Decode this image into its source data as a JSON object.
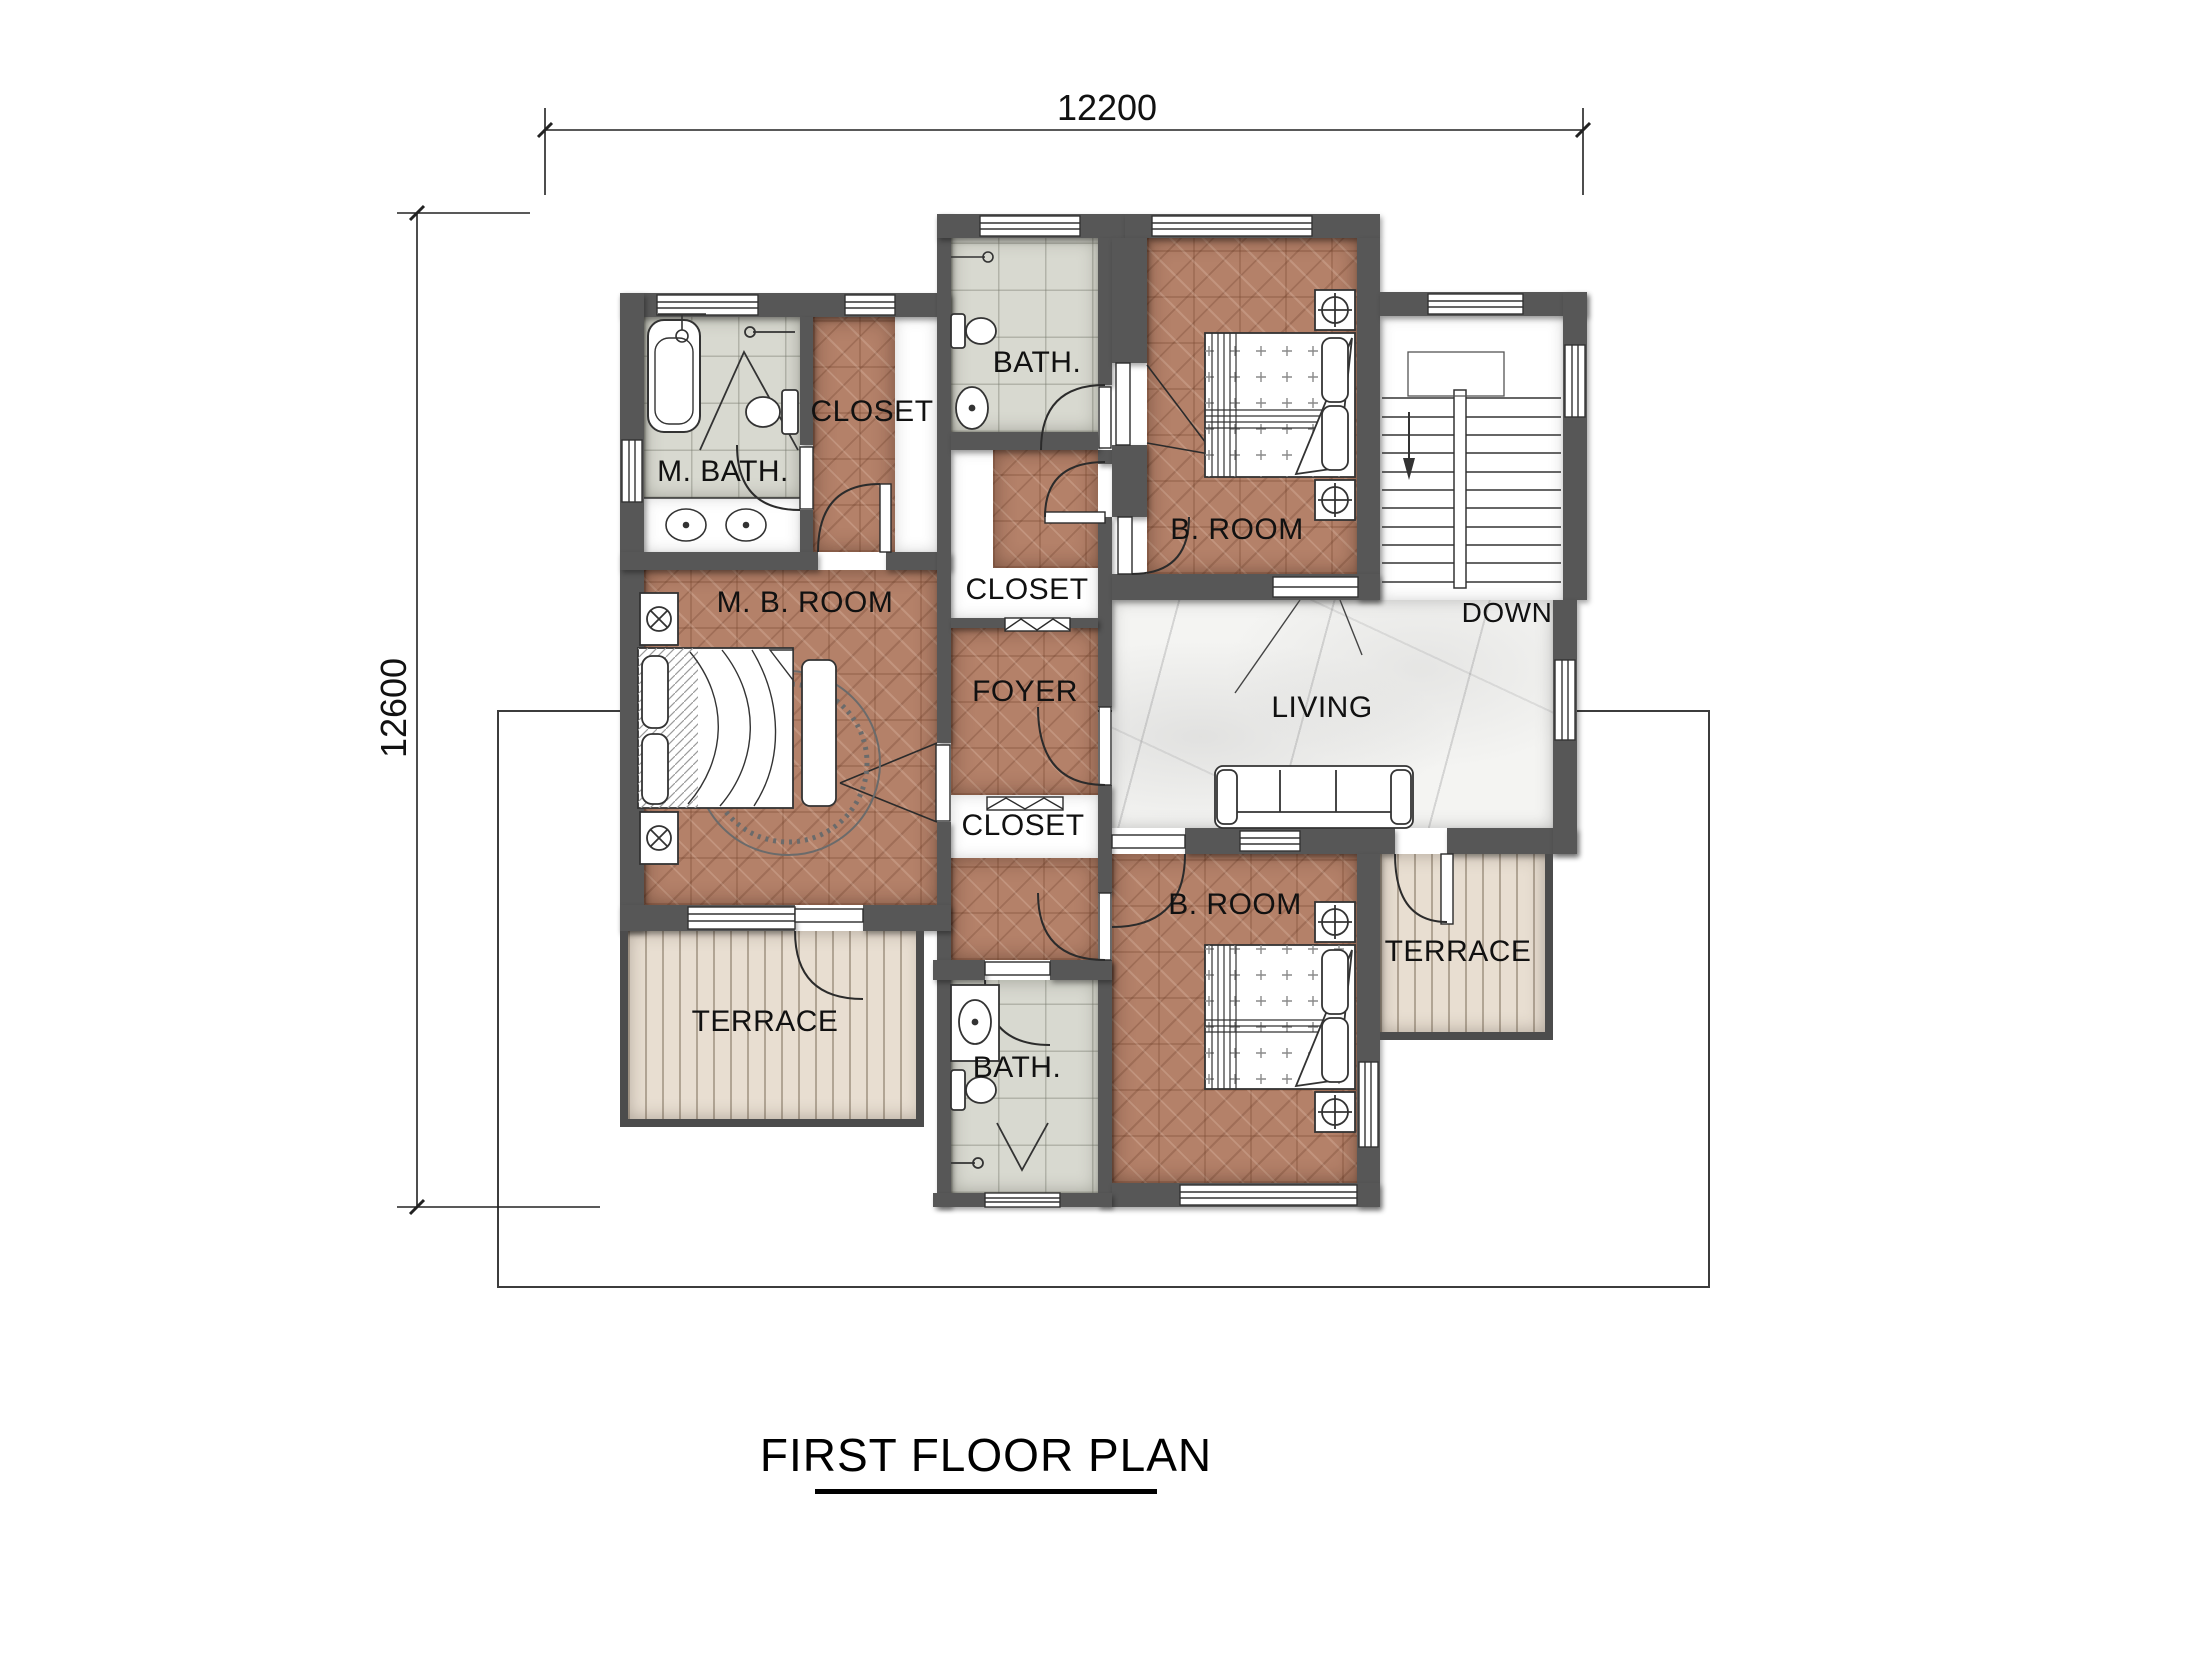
{
  "title": {
    "text": "FIRST FLOOR PLAN"
  },
  "dimensions": {
    "width_label": "12200",
    "height_label": "12600"
  },
  "labels": {
    "m_bath": "M. BATH.",
    "closet_top": "CLOSET",
    "bath_top": "BATH.",
    "broom_top": "B. ROOM",
    "down": "DOWN",
    "closet_mid": "CLOSET",
    "mb_room": "M. B. ROOM",
    "foyer": "FOYER",
    "living": "LIVING",
    "closet_bot": "CLOSET",
    "broom_bot": "B. ROOM",
    "bath_bot": "BATH.",
    "terrace_left": "TERRACE",
    "terrace_right": "TERRACE"
  },
  "colors": {
    "wall": "#575757",
    "wood_floor": "#b48169",
    "tile_floor": "#d8d9d0",
    "marble_floor": "#f4f4f2",
    "deck_floor": "#e8ded1",
    "linework": "#2b2b2b"
  }
}
